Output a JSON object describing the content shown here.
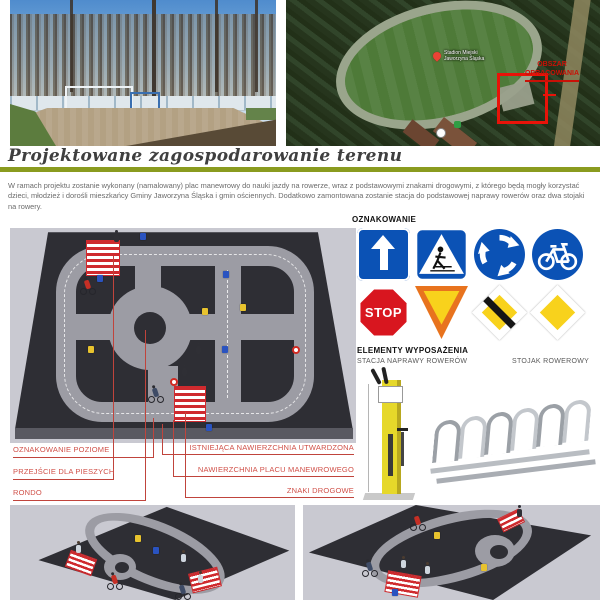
{
  "page": {
    "title": "Projektowane zagospodarowanie terenu",
    "description": "W ramach projektu zostanie wykonany  (namalowany) plac manewrowy do nauki jazdy na rowerze, wraz z podstawowymi znakami drogowymi, z którego będą mogły korzystać dzieci, młodzież i dorośli mieszkańcy Gminy Jaworzyna Śląska i gmin ościennych. Dodatkowo zamontowana zostanie stacja do podstawowej naprawy rowerów oraz dwa stojaki na rowery.",
    "colors": {
      "accent_green": "#8a9b1f",
      "callout_red": "#d05048",
      "sign_blue": "#0b52b5",
      "sign_red": "#d8161f",
      "sign_yellow": "#f8d21c",
      "render_platform": "#2e2e34",
      "render_road": "#9c9ca4"
    }
  },
  "aerial": {
    "pin_label": [
      "Stadion Miejski",
      "Jaworzyna Śląska"
    ],
    "annotation": [
      "OBSZAR",
      "OPRACOWANIA"
    ]
  },
  "signage": {
    "heading": "OZNAKOWANIE",
    "stop_label": "STOP",
    "signs": [
      "one-way-sign",
      "pedestrian-crossing-sign",
      "roundabout-sign",
      "bike-path-sign",
      "stop-sign",
      "yield-sign",
      "end-of-priority-road-sign",
      "priority-road-sign"
    ]
  },
  "equipment": {
    "heading": "ELEMENTY WYPOSAŻENIA",
    "items": [
      "STACJA NAPRAWY ROWERÓW",
      "STOJAK ROWEROWY"
    ]
  },
  "callouts": {
    "left": [
      "OZNAKOWANIE POZIOME",
      "PRZEJŚCIE DLA PIESZYCH",
      "RONDO"
    ],
    "right": [
      "ISTNIEJĄCA NAWIERZCHNIA UTWARDZONA",
      "NAWIERZCHNIA PLACU MANEWROWEGO",
      "ZNAKI DROGOWE"
    ]
  }
}
